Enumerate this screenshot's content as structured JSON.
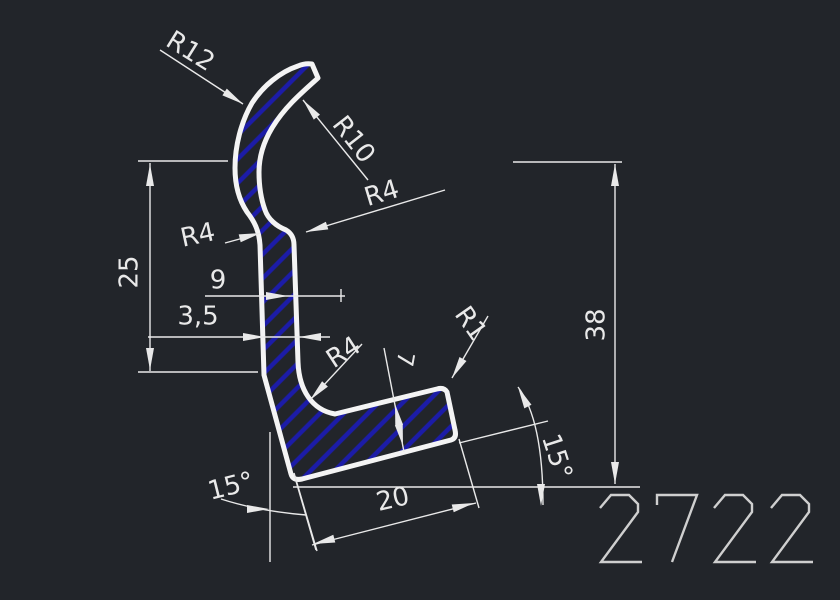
{
  "theme": {
    "bg": "#22252a",
    "line": "#f4f4f4",
    "hatch": "#1c1ca8",
    "dim": "#e9e9e9",
    "dimtext": "#e9e9e9",
    "pn": "#cfcfcf"
  },
  "drawing": {
    "type": "cad-profile-cross-section",
    "profile_number": "2722",
    "labels": {
      "r12": "R12",
      "r10": "R10",
      "r4_top": "R4",
      "r4_left": "R4",
      "r4_foot": "R4",
      "r1": "R1",
      "d25": "25",
      "d9": "9",
      "d35": "3,5",
      "d7": "7",
      "d38": "38",
      "d20": "20",
      "a15_left": "15°",
      "a15_right": "15°"
    }
  }
}
